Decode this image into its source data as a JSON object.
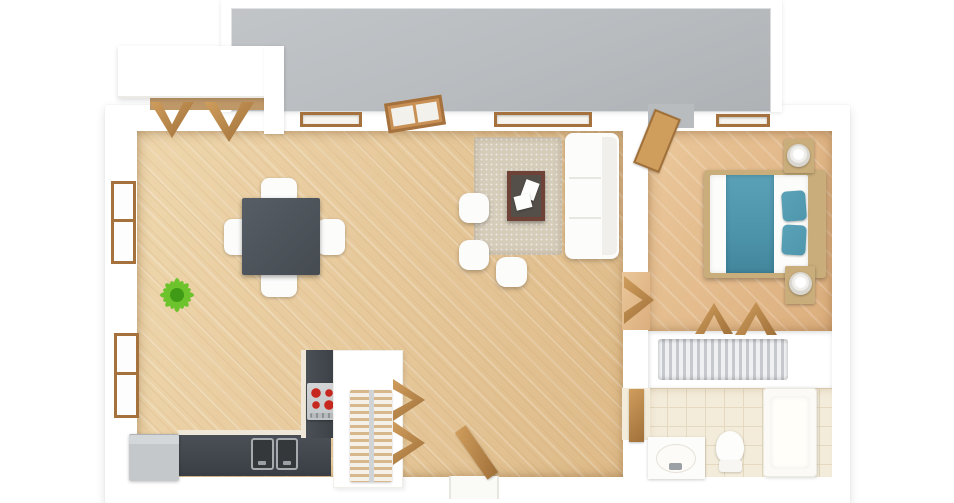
{
  "meta": {
    "title": "3D rendered top-down floor plan of a one-bedroom apartment with balcony",
    "render_style": "photoreal 3d dollhouse view",
    "canvas": {
      "width": 954,
      "height": 503
    },
    "visible_text": "none"
  },
  "palette": {
    "wall": "#ffffff",
    "balcony_floor": "#b8bcbf",
    "wood_light": "#eed6ac",
    "wood_deep": "#deba88",
    "wood_bedroom_light": "#eac79a",
    "wood_bedroom_deep": "#dcae7d",
    "wood_entry": "#bf9868",
    "charcoal_counter": "#41474d",
    "table_gray": "#4e555c",
    "appliance_gray": "#c4c8cb",
    "stove_panel": "#d2d4d6",
    "burner_red": "#c6271f",
    "rug_beige": "#d5ccba",
    "coffee_frame": "#6f4238",
    "coffee_top": "#544f49",
    "furniture_white": "#fcfcfb",
    "teal": "#4f96ac",
    "bed_wood": "#c9ad7b",
    "door_wood_light": "#cf9d5c",
    "door_wood_dark": "#a0703a",
    "window_frame": "#a5713c",
    "tile": "#f4ecda",
    "tile_line": "#e5d9c0",
    "clothes_light": "#eef0f2",
    "clothes_dark": "#c5c8cd",
    "plant_green": "#6cc32c",
    "plant_dark": "#3f9a16",
    "pot_brown": "#7c3b2c",
    "shelf_stripe": "#d7b88c"
  },
  "rooms": [
    {
      "id": "balcony",
      "label": "Balcony terrace (gray floor) along the top"
    },
    {
      "id": "living",
      "label": "Open-plan living and dining room with kitchen, wood floor"
    },
    {
      "id": "bedroom",
      "label": "Bedroom with double bed, wood floor"
    },
    {
      "id": "wardrobe",
      "label": "Built-in wardrobe with hanging clothes"
    },
    {
      "id": "bathroom",
      "label": "Bathroom with tub, toilet and vanity, cream tile floor"
    },
    {
      "id": "entry-closet",
      "label": "Storage closet with bifold doors, top left"
    }
  ],
  "furniture": {
    "living_dining": [
      "square dining table (dark gray)",
      "4 white dining chairs",
      "green potted plant",
      "beige shag rug",
      "coffee table with white magazines",
      "white three-seat sofa",
      "3 white ottoman poufs"
    ],
    "kitchen": [
      "L-shaped charcoal counter",
      "cooktop with 4 red burners",
      "double sink",
      "gray refrigerator",
      "pantry shelving unit",
      "wooden bifold pantry doors"
    ],
    "bedroom": [
      "double bed with teal runner and 2 teal pillows",
      "2 wood nightstands with white lamps",
      "open wooden balcony door",
      "wooden room door"
    ],
    "wardrobe": [
      "clothes hanging on rail",
      "wooden bifold closet doors"
    ],
    "bathroom": [
      "vanity with oval sink",
      "toilet",
      "bathtub",
      "wooden door"
    ],
    "openings": [
      "2 left-wall windows",
      "2 top-wall windows",
      "bedroom window",
      "glazed balcony door (living room)",
      "open entry door (bottom wall)"
    ]
  }
}
